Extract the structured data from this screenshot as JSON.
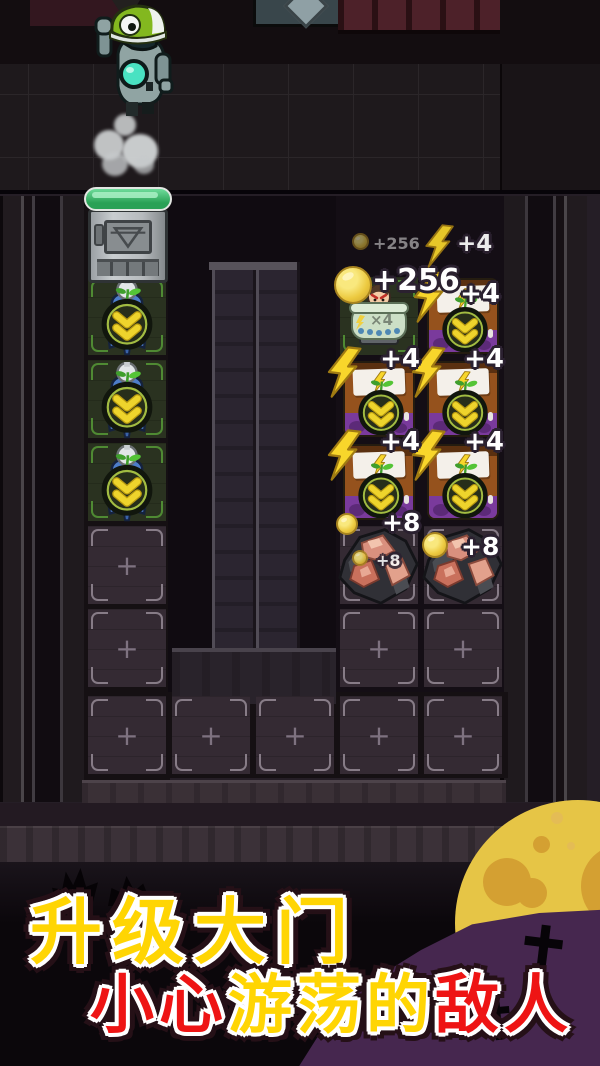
{
  "colors": {
    "coin_gold": "#ecc93f",
    "lightning_yellow": "#f8d62b",
    "hp_green": "#2aa156",
    "moon_yellow": "#e6c546",
    "hill_purple": "#46274f",
    "banner_yellow": "#ffd503",
    "banner_red": "#ee1414",
    "bracket_green": "#4f8a33"
  },
  "gate": {
    "hp_percent": 100
  },
  "ambient_floaters": {
    "coin": {
      "icon": "coin-icon",
      "text": "+256"
    },
    "bolt": {
      "icon": "lightning-icon",
      "text": "+4"
    }
  },
  "enemy_pot": {
    "coin_text": "+256",
    "multiplier": "×4"
  },
  "cards": [
    {
      "gain": "+4"
    },
    {
      "gain": "+4"
    },
    {
      "gain": "+4"
    },
    {
      "gain": "+4"
    },
    {
      "gain": "+4"
    }
  ],
  "meat": {
    "left": {
      "coin_text": "+8",
      "inner_coin_text": "+8"
    },
    "right": {
      "coin_text": "+8"
    }
  },
  "board": {
    "plus_symbol": "+"
  },
  "banner": {
    "line1": [
      {
        "text": "升级大门",
        "color": "#ffd503"
      }
    ],
    "line2": [
      {
        "text": "小心",
        "color": "#ee1414"
      },
      {
        "text": "游荡的",
        "color": "#ffd503"
      },
      {
        "text": "敌人",
        "color": "#ee1414"
      }
    ]
  }
}
